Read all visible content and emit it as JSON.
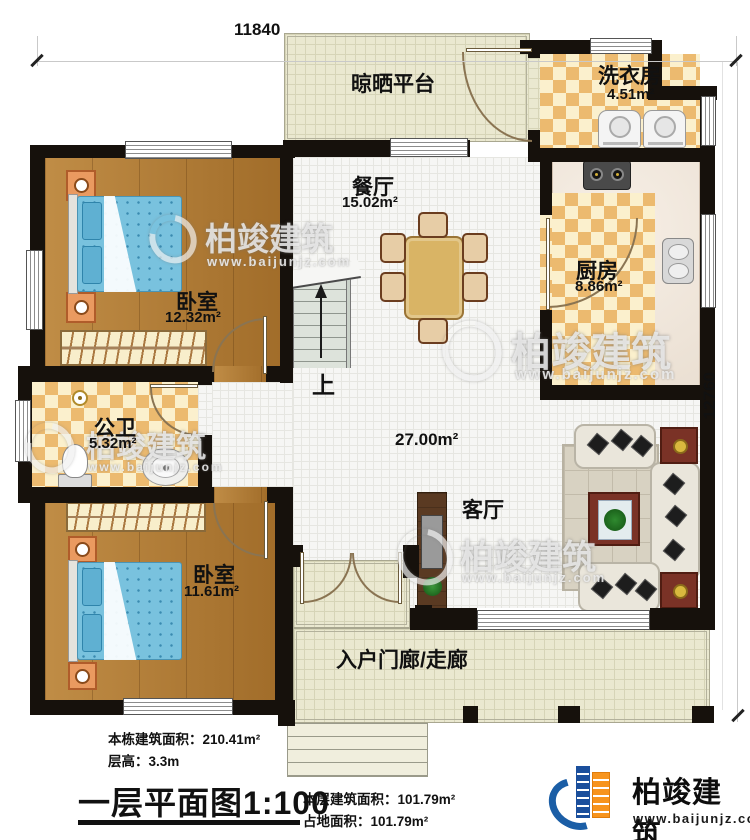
{
  "dimensions": {
    "top_width": "11840",
    "right_height": "12760"
  },
  "rooms": {
    "platform": {
      "name": "晾晒平台"
    },
    "laundry": {
      "name": "洗衣房",
      "area": "4.51m²"
    },
    "dining": {
      "name": "餐厅",
      "area": "15.02m²"
    },
    "kitchen": {
      "name": "厨房",
      "area": "8.86m²"
    },
    "bedroom_top": {
      "name": "卧室",
      "area": "12.32m²"
    },
    "bathroom": {
      "name": "公卫",
      "area": "5.32m²"
    },
    "bedroom_bottom": {
      "name": "卧室",
      "area": "11.61m²"
    },
    "living": {
      "name": "客厅",
      "area": "27.00m²"
    },
    "porch": {
      "name": "入户门廊/走廊"
    },
    "stairs": {
      "up_label": "上"
    }
  },
  "title_block": {
    "building_total_area": "本栋建筑面积：210.41m²",
    "floor_height": "层高：3.3m",
    "plan_title": "一层平面图",
    "plan_scale": "1:100",
    "floor_area": "本层建筑面积：101.79m²",
    "footprint_area": "占地面积：101.79m²"
  },
  "branding": {
    "company": "柏竣建筑",
    "website": "www.baijunjz.com"
  },
  "watermark": {
    "company": "柏竣建筑",
    "website": "www.baijunjz.com"
  },
  "colors": {
    "wall": "#16110c",
    "wood_floor": "#b27a30",
    "checker_tile": "#ecba6f",
    "white_tile": "#f6f6f4",
    "outdoor_grid": "#eae8d0",
    "bed": "#79c2de",
    "brand_orange": "#f7941d",
    "brand_blue": "#1b5ea6"
  }
}
